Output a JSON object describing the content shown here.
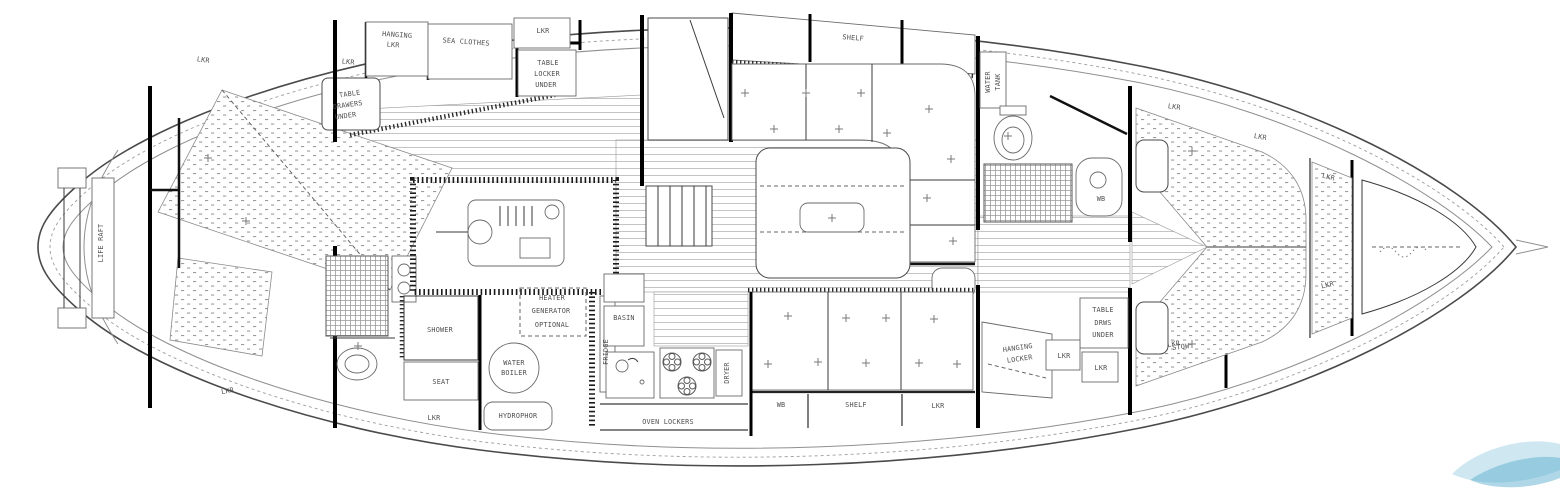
{
  "title": "Sailing yacht interior accommodation plan (top view line drawing)",
  "colors": {
    "background": "#ffffff",
    "ink": "#2b2b2b",
    "light_line": "#9a9a9a",
    "plank_line": "#b6b6b6",
    "watermark_blue_light": "#a6d3e6",
    "watermark_blue": "#5fb0d0"
  },
  "labels": [
    {
      "name": "life-raft",
      "text": "LIFE RAFT",
      "x": 103,
      "y": 243,
      "rot": -90
    },
    {
      "name": "lkr-stern-top",
      "text": "LKR",
      "x": 203,
      "y": 62,
      "rot": 8
    },
    {
      "name": "lkr-aft-top",
      "text": "LKR",
      "x": 348,
      "y": 64,
      "rot": 6
    },
    {
      "name": "hanging-lkr-line1",
      "text": "HANGING",
      "x": 397,
      "y": 37,
      "rot": 4
    },
    {
      "name": "hanging-lkr-line2",
      "text": "LKR",
      "x": 393,
      "y": 47,
      "rot": 4
    },
    {
      "name": "sea-clothes",
      "text": "SEA CLOTHES",
      "x": 466,
      "y": 44,
      "rot": 4
    },
    {
      "name": "lkr-mid-top",
      "text": "LKR",
      "x": 543,
      "y": 33
    },
    {
      "name": "table-locker-line1",
      "text": "TABLE",
      "x": 548,
      "y": 65
    },
    {
      "name": "table-locker-line2",
      "text": "LOCKER",
      "x": 547,
      "y": 76
    },
    {
      "name": "table-locker-line3",
      "text": "UNDER",
      "x": 546,
      "y": 87
    },
    {
      "name": "table-drawers-line1",
      "text": "TABLE",
      "x": 350,
      "y": 96,
      "rot": -8
    },
    {
      "name": "table-drawers-line2",
      "text": "DRAWERS",
      "x": 348,
      "y": 107,
      "rot": -8
    },
    {
      "name": "table-drawers-line3",
      "text": "UNDER",
      "x": 346,
      "y": 118,
      "rot": -8
    },
    {
      "name": "lkr-aft-hull",
      "text": "LKR",
      "x": 228,
      "y": 393,
      "rot": -10
    },
    {
      "name": "shower",
      "text": "SHOWER",
      "x": 440,
      "y": 332
    },
    {
      "name": "seat",
      "text": "SEAT",
      "x": 441,
      "y": 384
    },
    {
      "name": "lkr-aft-bottom",
      "text": "LKR",
      "x": 434,
      "y": 420
    },
    {
      "name": "heater",
      "text": "HEATER",
      "x": 552,
      "y": 300
    },
    {
      "name": "generator",
      "text": "GENERATOR",
      "x": 551,
      "y": 313
    },
    {
      "name": "optional",
      "text": "OPTIONAL",
      "x": 552,
      "y": 327
    },
    {
      "name": "water-boiler-line1",
      "text": "WATER",
      "x": 514,
      "y": 365
    },
    {
      "name": "water-boiler-line2",
      "text": "BOILER",
      "x": 514,
      "y": 375
    },
    {
      "name": "hydrophor",
      "text": "HYDROPHOR",
      "x": 518,
      "y": 418
    },
    {
      "name": "fridge",
      "text": "FRIDGE",
      "x": 608,
      "y": 352,
      "rot": -90
    },
    {
      "name": "basin",
      "text": "BASIN",
      "x": 624,
      "y": 320
    },
    {
      "name": "dryer",
      "text": "DRYER",
      "x": 729,
      "y": 373,
      "rot": -90
    },
    {
      "name": "oven-lockers",
      "text": "OVEN LOCKERS",
      "x": 668,
      "y": 424
    },
    {
      "name": "shelf-top",
      "text": "SHELF",
      "x": 853,
      "y": 40,
      "rot": 5
    },
    {
      "name": "wb-saloon",
      "text": "WB",
      "x": 781,
      "y": 407
    },
    {
      "name": "shelf-saloon",
      "text": "SHELF",
      "x": 856,
      "y": 407
    },
    {
      "name": "lkr-saloon",
      "text": "LKR",
      "x": 938,
      "y": 408
    },
    {
      "name": "water-tank-line1",
      "text": "WATER",
      "x": 990,
      "y": 82,
      "rot": -90
    },
    {
      "name": "water-tank-line2",
      "text": "TANK",
      "x": 1000,
      "y": 82,
      "rot": -90
    },
    {
      "name": "wb-head",
      "text": "WB",
      "x": 1101,
      "y": 201
    },
    {
      "name": "hanging-locker-line1",
      "text": "HANGING",
      "x": 1018,
      "y": 350,
      "rot": -8
    },
    {
      "name": "hanging-locker-line2",
      "text": "LOCKER",
      "x": 1020,
      "y": 361,
      "rot": -8
    },
    {
      "name": "table-fwd",
      "text": "TABLE",
      "x": 1103,
      "y": 312
    },
    {
      "name": "drws-under-line1",
      "text": "DRWS",
      "x": 1103,
      "y": 325
    },
    {
      "name": "drws-under-line2",
      "text": "UNDER",
      "x": 1103,
      "y": 337
    },
    {
      "name": "lkr-fwd-1",
      "text": "LKR",
      "x": 1064,
      "y": 358
    },
    {
      "name": "lkr-fwd-2",
      "text": "LKR",
      "x": 1101,
      "y": 370
    },
    {
      "name": "stow",
      "text": "STOW",
      "x": 1181,
      "y": 349,
      "rot": -6
    },
    {
      "name": "lkr-vberth-top",
      "text": "LKR",
      "x": 1174,
      "y": 109,
      "rot": 8
    },
    {
      "name": "lkr-vberth-mid",
      "text": "LKR",
      "x": 1260,
      "y": 139,
      "rot": 10
    },
    {
      "name": "lkr-vberth-bottom",
      "text": "LKR",
      "x": 1174,
      "y": 346,
      "rot": -8
    },
    {
      "name": "lkr-bow-top",
      "text": "LKR",
      "x": 1328,
      "y": 179,
      "rot": 14
    },
    {
      "name": "lkr-bow-bottom",
      "text": "LKR",
      "x": 1328,
      "y": 287,
      "rot": -14
    }
  ],
  "plus_marks": [
    [
      745,
      93
    ],
    [
      806,
      93
    ],
    [
      861,
      93
    ],
    [
      774,
      129
    ],
    [
      839,
      129
    ],
    [
      887,
      133
    ],
    [
      929,
      109
    ],
    [
      951,
      159
    ],
    [
      927,
      198
    ],
    [
      953,
      241
    ],
    [
      832,
      218
    ],
    [
      788,
      316
    ],
    [
      846,
      318
    ],
    [
      886,
      318
    ],
    [
      934,
      319
    ],
    [
      768,
      364
    ],
    [
      818,
      362
    ],
    [
      866,
      363
    ],
    [
      919,
      363
    ],
    [
      957,
      364
    ],
    [
      246,
      221
    ],
    [
      208,
      158
    ],
    [
      358,
      346
    ],
    [
      1008,
      136
    ],
    [
      1192,
      151
    ],
    [
      1192,
      344
    ]
  ],
  "burners": [
    [
      672,
      362
    ],
    [
      702,
      362
    ],
    [
      687,
      386
    ]
  ]
}
